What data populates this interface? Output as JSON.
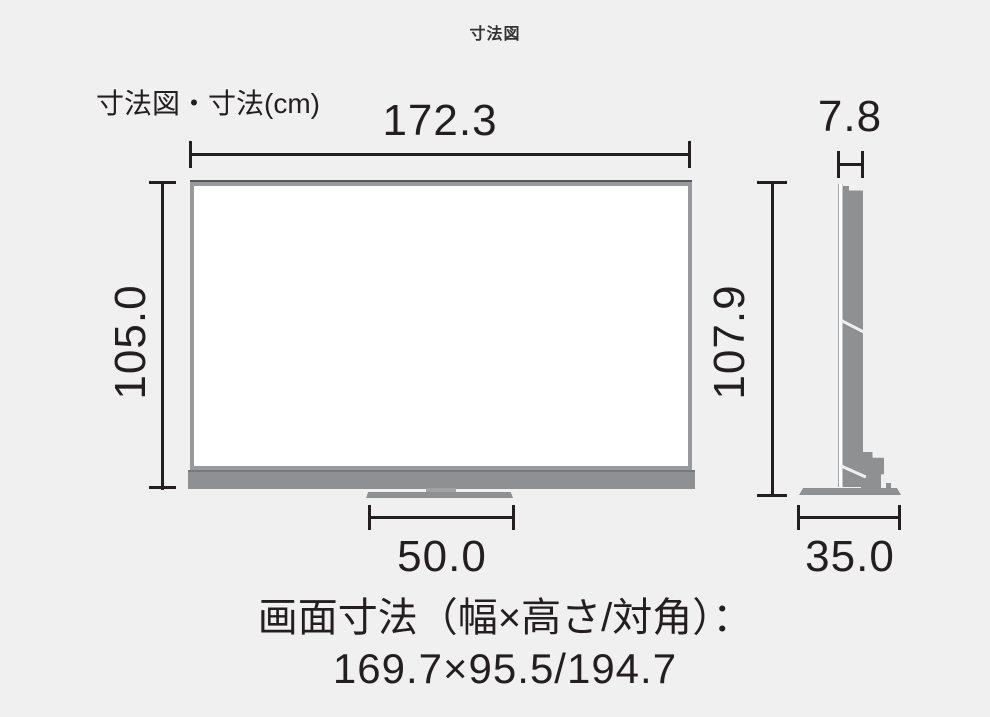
{
  "page": {
    "title": "寸法図"
  },
  "diagram": {
    "corner_label": "寸法図・寸法(cm)",
    "front_view": {
      "width_cm": "172.3",
      "panel_height_cm": "105.0",
      "total_height_cm": "107.9",
      "stand_width_cm": "50.0"
    },
    "side_view": {
      "depth_cm": "7.8",
      "stand_depth_cm": "35.0"
    },
    "footer": {
      "screen_size_label": "画面寸法（幅×高さ/対角）：",
      "screen_size_value": "169.7×95.5/194.7"
    },
    "colors": {
      "background": "#f0f0f1",
      "line": "#231f20",
      "tv_gray": "#8e9092"
    }
  }
}
